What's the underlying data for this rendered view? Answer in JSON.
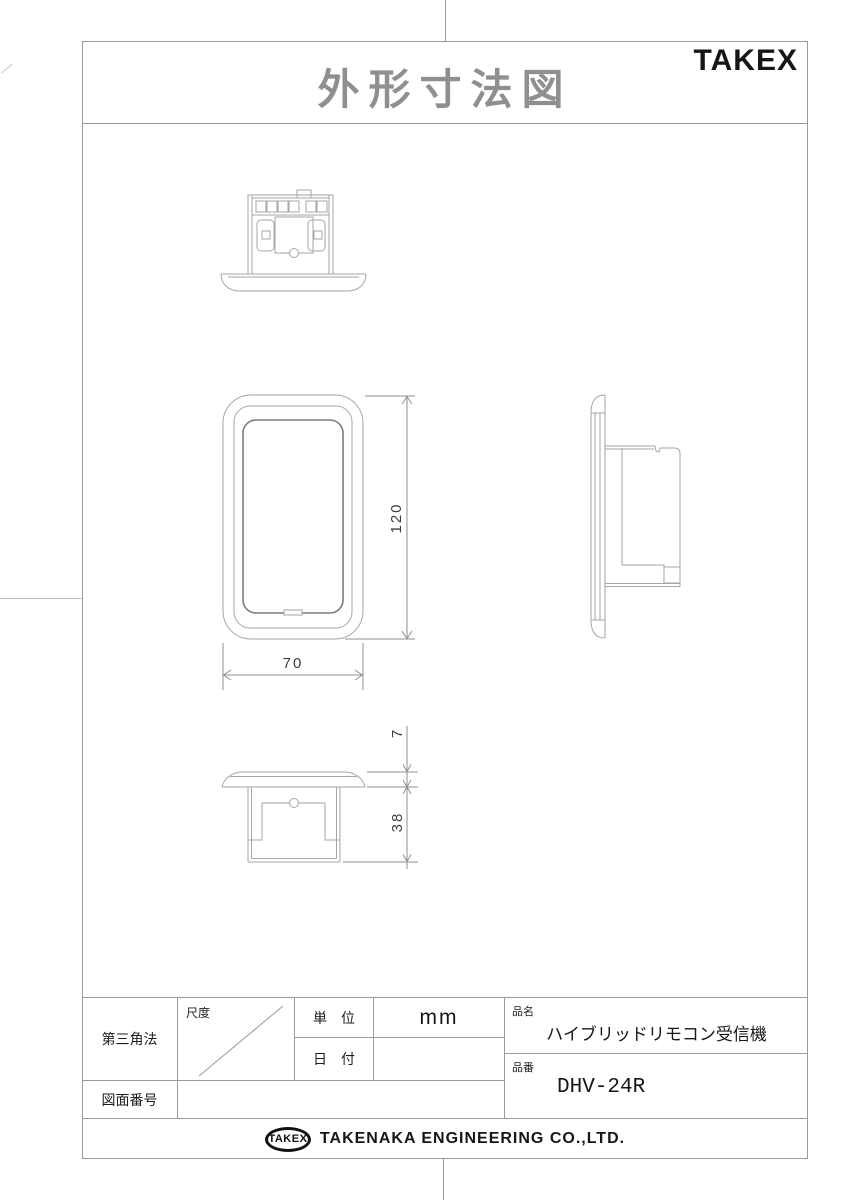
{
  "header": {
    "title": "外形寸法図",
    "brand": "TAKEX"
  },
  "dimensions": {
    "height": "120",
    "width": "70",
    "flange": "7",
    "depth": "38"
  },
  "title_block": {
    "projection": "第三角法",
    "scale_label": "尺度",
    "unit_label": "単　位",
    "unit_value": "mm",
    "date_label": "日　付",
    "date_value": "",
    "drawing_no_label": "図面番号",
    "drawing_no_value": "",
    "product_name_label": "品名",
    "product_name_value": "ハイブリッドリモコン受信機",
    "part_no_label": "品番",
    "part_no_value": "DHV-24R"
  },
  "footer": {
    "logo": "TAKEX",
    "company": "TAKENAKA ENGINEERING CO.,LTD."
  }
}
